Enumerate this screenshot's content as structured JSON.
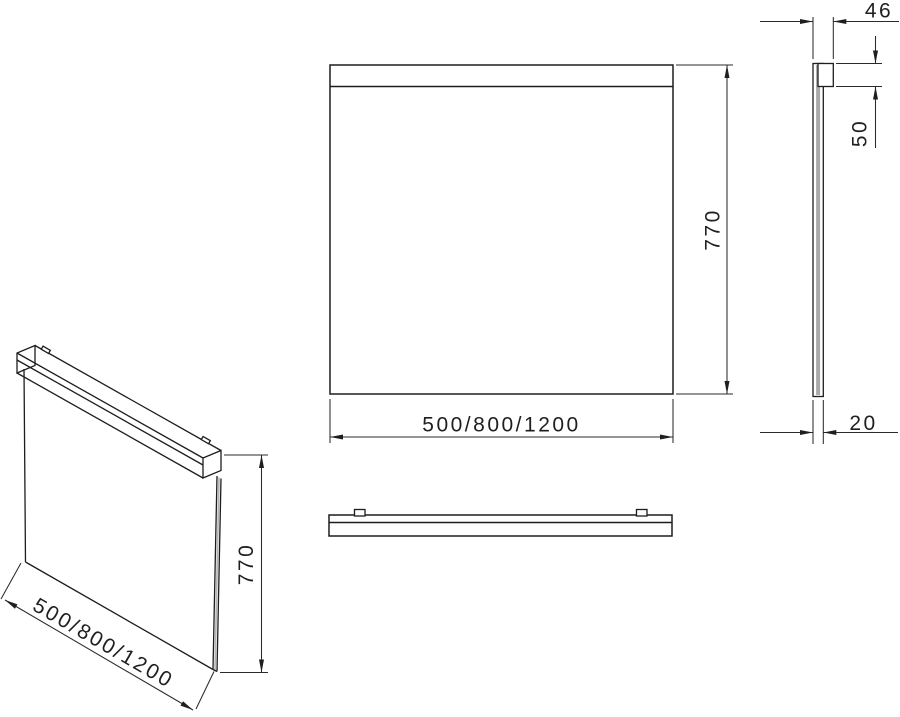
{
  "labels": {
    "front": {
      "width": "500/800/1200",
      "height": "770"
    },
    "side": {
      "depth": "46",
      "light_height": "50",
      "thickness": "20"
    },
    "iso": {
      "width": "500/800/1200",
      "height": "770"
    }
  },
  "colors": {
    "line": "#1d1d1d",
    "dimension": "#2b2b2b",
    "text": "#1f1f1f",
    "glass_edge_gray": "#a9a9a9",
    "background": "#ffffff"
  }
}
